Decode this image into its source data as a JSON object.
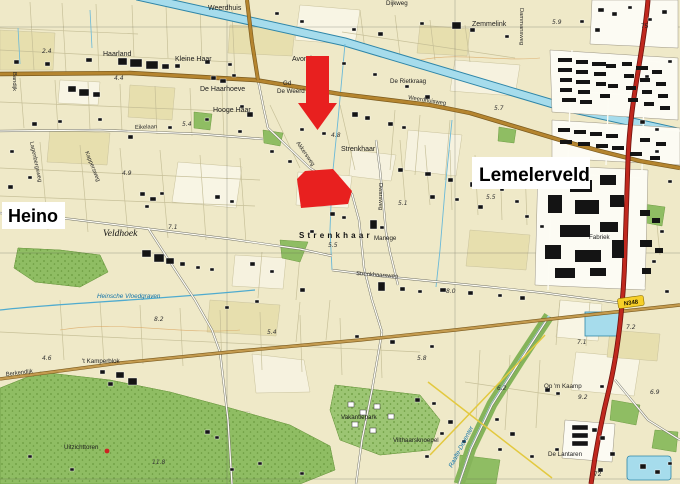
{
  "overlay": {
    "heino": "Heino",
    "lemelerveld": "Lemelerveld"
  },
  "places": {
    "weerdhuis": "Weerdhuis",
    "haarland": "Haarland",
    "kleine_haar": "Kleine Haar",
    "de_haarhoeve": "De Haarhoeve",
    "hooge_haar": "Hooge Haar",
    "avondster": "Avondster",
    "gd": "Gd",
    "de_weerd": "De Weerd",
    "zemmelink": "Zemmelink",
    "de_rietkraag": "De Rietkraag",
    "dijkweg": "Dijkweg",
    "strenkhaar": "Strenkhaar",
    "strenkhaar_hamlet": "Strenkhaar",
    "veldhoek": "Veldhoek",
    "manege": "Manege",
    "kamperblok": "'t Kamperblok",
    "uitzichttoren": "Uitzichttoren",
    "vakantiepark": "Vakantiepark",
    "vilthaarsknoepel": "Vilthaarsknoepel",
    "op_m_kaamp": "Op 'm Kaamp",
    "de_lantaren": "De Lantaren",
    "fabriek": "Fabriek"
  },
  "roads": {
    "eikelaan": "Eikelaan",
    "weerdhuisweg": "Weerdhuisweg",
    "akkersweg": "Akkersweg",
    "dwarsweg": "Dwarsweg",
    "strenkhaarsweg": "Strenkhaarsweg",
    "berkendijk": "Berkendijk",
    "dammansweg": "Dammansweg",
    "lagenbergsweg": "Lagenbergsweg",
    "kappersweg": "Kappersweg",
    "bandijk": "Bandijk"
  },
  "water": {
    "heinsche_vloedgraven": "Heinsche Vloedgraven",
    "raalte_deventer": "Raalte-Deventer"
  },
  "shield": "N348",
  "markers": {
    "km75": "75",
    "km72": "72"
  },
  "heights": {
    "h1": "2.4",
    "h2": "4.4",
    "h3": "5.4",
    "h4": "4.9",
    "h5": "7.1",
    "h6": "4.8",
    "h7": "5.5",
    "h8": "5.5",
    "h9": "5.1",
    "h10": "5.7",
    "h11": "5.9",
    "h12": "4.6",
    "h13": "5.4",
    "h14": "11.8",
    "h15": "5.8",
    "h16": "6.2",
    "h17": "7.1",
    "h18": "9.2",
    "h19": "8.0",
    "h20": "7.2",
    "h21": "6.9",
    "h22": "8.2"
  },
  "colors": {
    "annotation_red": "#E8201F",
    "main_road_brown": "#B5852F",
    "n_road_red": "#C0281E",
    "water_blue": "#A6DCEC",
    "forest_green": "#8FBD63",
    "shield_yellow": "#F7D028"
  }
}
